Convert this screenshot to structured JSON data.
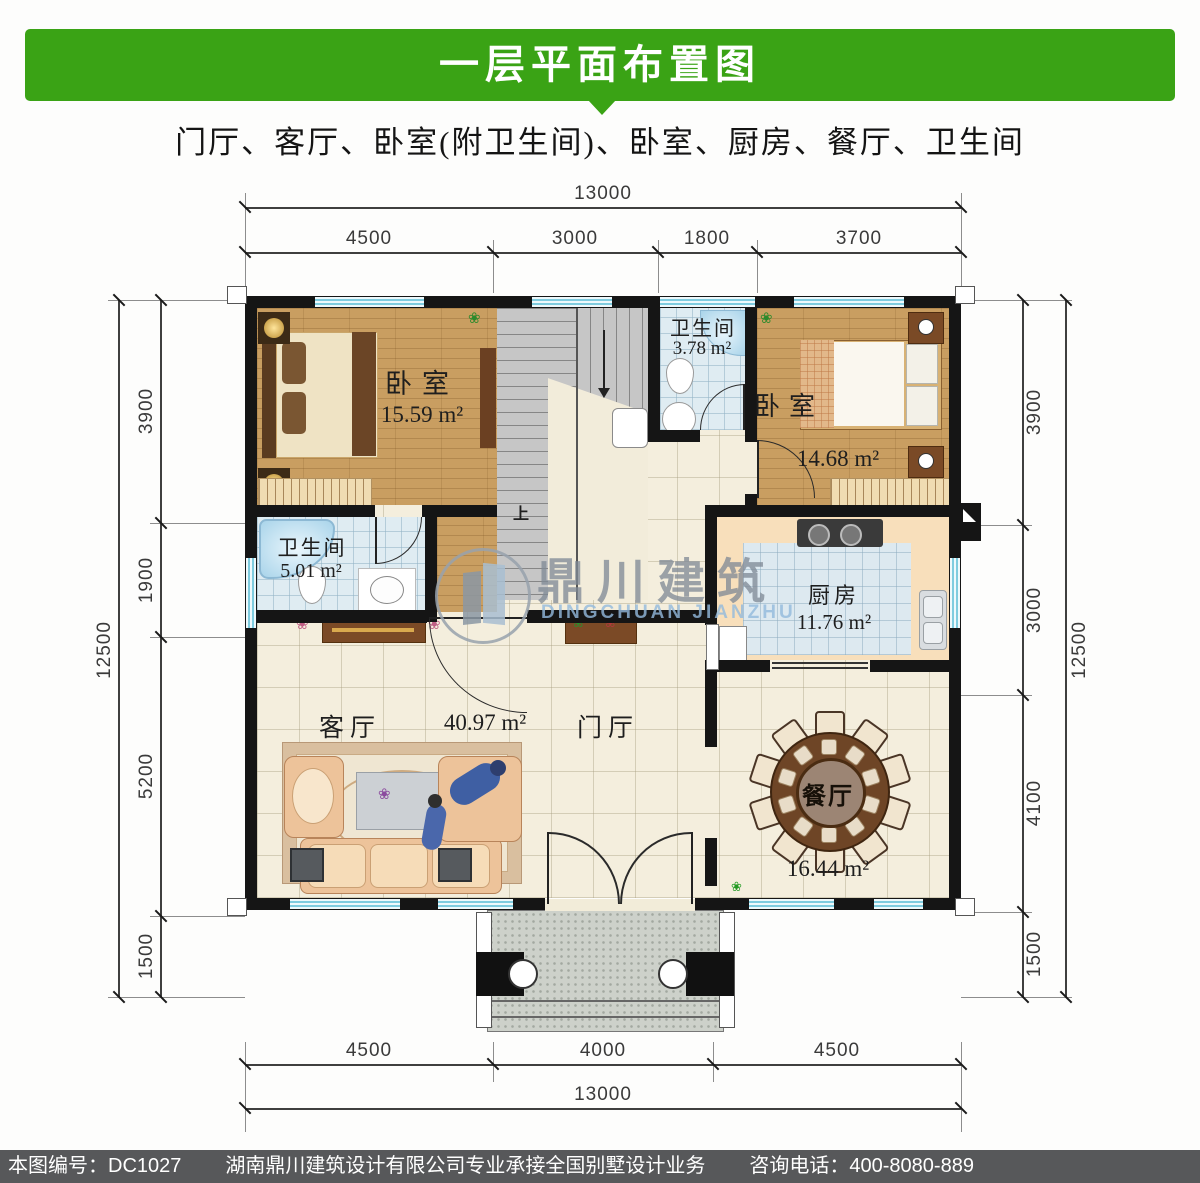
{
  "header": {
    "title": "一层平面布置图"
  },
  "subtitle": "门厅、客厅、卧室(附卫生间)、卧室、厨房、餐厅、卫生间",
  "colors": {
    "header_green": "#3aa315",
    "footer_gray": "#57585a",
    "wall_black": "#151515",
    "window_cyan": "#7fccdf"
  },
  "dimensions": {
    "top": {
      "overall": "13000",
      "segments": [
        "4500",
        "3000",
        "1800",
        "3700"
      ]
    },
    "bottom": {
      "overall": "13000",
      "segments": [
        "4500",
        "4000",
        "4500"
      ]
    },
    "left": {
      "overall": "12500",
      "segments": [
        "3900",
        "1900",
        "5200",
        "1500"
      ]
    },
    "right": {
      "overall": "12500",
      "segments": [
        "3900",
        "3000",
        "4100",
        "1500"
      ]
    }
  },
  "rooms": {
    "bedroom_left": {
      "name": "卧室",
      "area": "15.59 m²"
    },
    "bathroom_top": {
      "name": "卫生间",
      "area": "3.78 m²"
    },
    "bedroom_right": {
      "name": "卧室",
      "area": "14.68 m²"
    },
    "bathroom_left": {
      "name": "卫生间",
      "area": "5.01 m²"
    },
    "kitchen": {
      "name": "厨房",
      "area": "11.76 m²"
    },
    "living": {
      "name": "客厅",
      "area": "40.97 m²"
    },
    "foyer": {
      "name": "门厅"
    },
    "dining": {
      "name": "餐厅",
      "area": "16.44 m²"
    },
    "stairs": {
      "up_label": "上"
    }
  },
  "watermark": {
    "cn": "鼎川建筑",
    "en": "DINGCHUAN JIANZHU"
  },
  "footer": {
    "drawing_no": "本图编号：DC1027",
    "company": "湖南鼎川建筑设计有限公司专业承接全国别墅设计业务",
    "phone": "咨询电话：400-8080-889"
  }
}
